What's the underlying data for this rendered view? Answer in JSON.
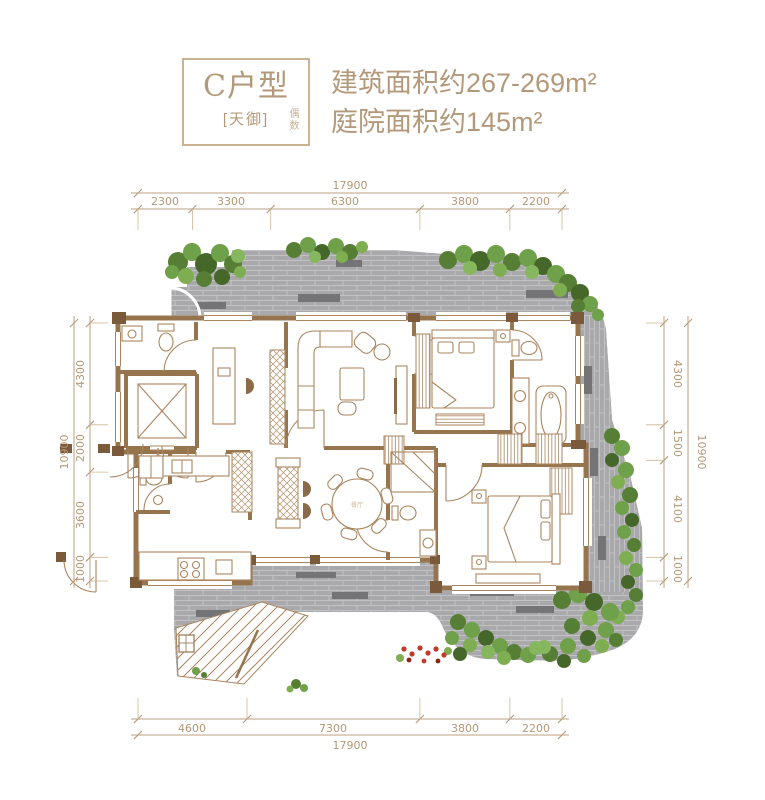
{
  "header": {
    "unit_label": "C户型",
    "project_label": "[天御]",
    "note_label": "偶数",
    "area_building": "建筑面积约267-269m²",
    "area_courtyard": "庭院面积约145m²"
  },
  "dimensions": {
    "top": {
      "total": "17900",
      "segments": [
        "2300",
        "3300",
        "6300",
        "3800",
        "2200"
      ]
    },
    "bottom": {
      "total": "17900",
      "segments": [
        "4600",
        "7300",
        "3800",
        "2200"
      ]
    },
    "left": {
      "total": "10900",
      "segments": [
        "4300",
        "2000",
        "3600",
        "1000"
      ]
    },
    "right": {
      "total": "10900",
      "segments": [
        "4300",
        "1500",
        "4100",
        "1000"
      ]
    }
  },
  "plan": {
    "dining_label": "餐厅"
  },
  "colors": {
    "accent_tan": "#b3997a",
    "wall_brown": "#96744e",
    "furniture_line": "#a9855f",
    "paving_grey": "#a9a9ab",
    "paving_dark": "#747477",
    "foliage_green": "#6fa04a",
    "flower_red": "#c23a28"
  }
}
